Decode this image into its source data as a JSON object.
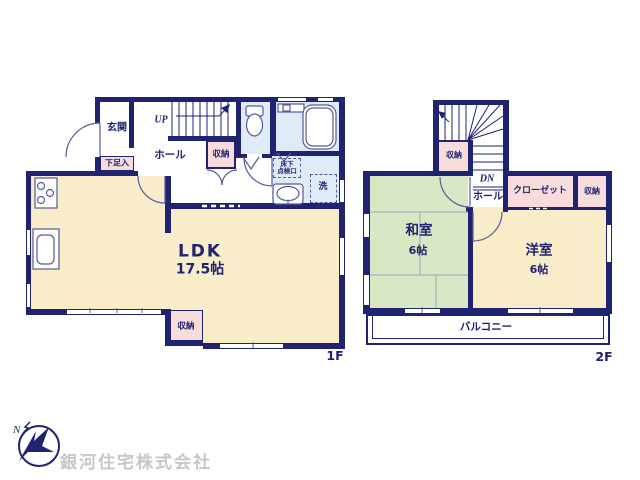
{
  "colors": {
    "navy": "#1f2370",
    "thin": "#555b9e",
    "cream": "#f9ecc9",
    "green": "#d9e7c5",
    "pink": "#f8dcdb",
    "blue": "#dfecf7",
    "tatami": "#9aa3c6",
    "wm": "#c7c7c7"
  },
  "floor1": {
    "floor_label": "1F",
    "entrance": "玄関",
    "shoe_cabinet": "下足入",
    "stairs_direction": "UP",
    "hall": "ホール",
    "hall_storage": "収納",
    "underfloor_hatch_line1": "床下",
    "underfloor_hatch_line2": "点検口",
    "laundry": "洗",
    "ldk_name": "LDK",
    "ldk_size": "17.5帖",
    "ldk_storage": "収納"
  },
  "floor2": {
    "floor_label": "2F",
    "stair_storage": "収納",
    "stairs_direction": "DN",
    "hall": "ホール",
    "closet": "クローゼット",
    "storage": "収納",
    "japanese_room_name": "和室",
    "japanese_room_size": "6帖",
    "western_room_name": "洋室",
    "western_room_size": "6帖",
    "balcony": "バルコニー"
  },
  "footer": {
    "company_name": "銀河住宅株式会社",
    "compass_north": "N"
  }
}
